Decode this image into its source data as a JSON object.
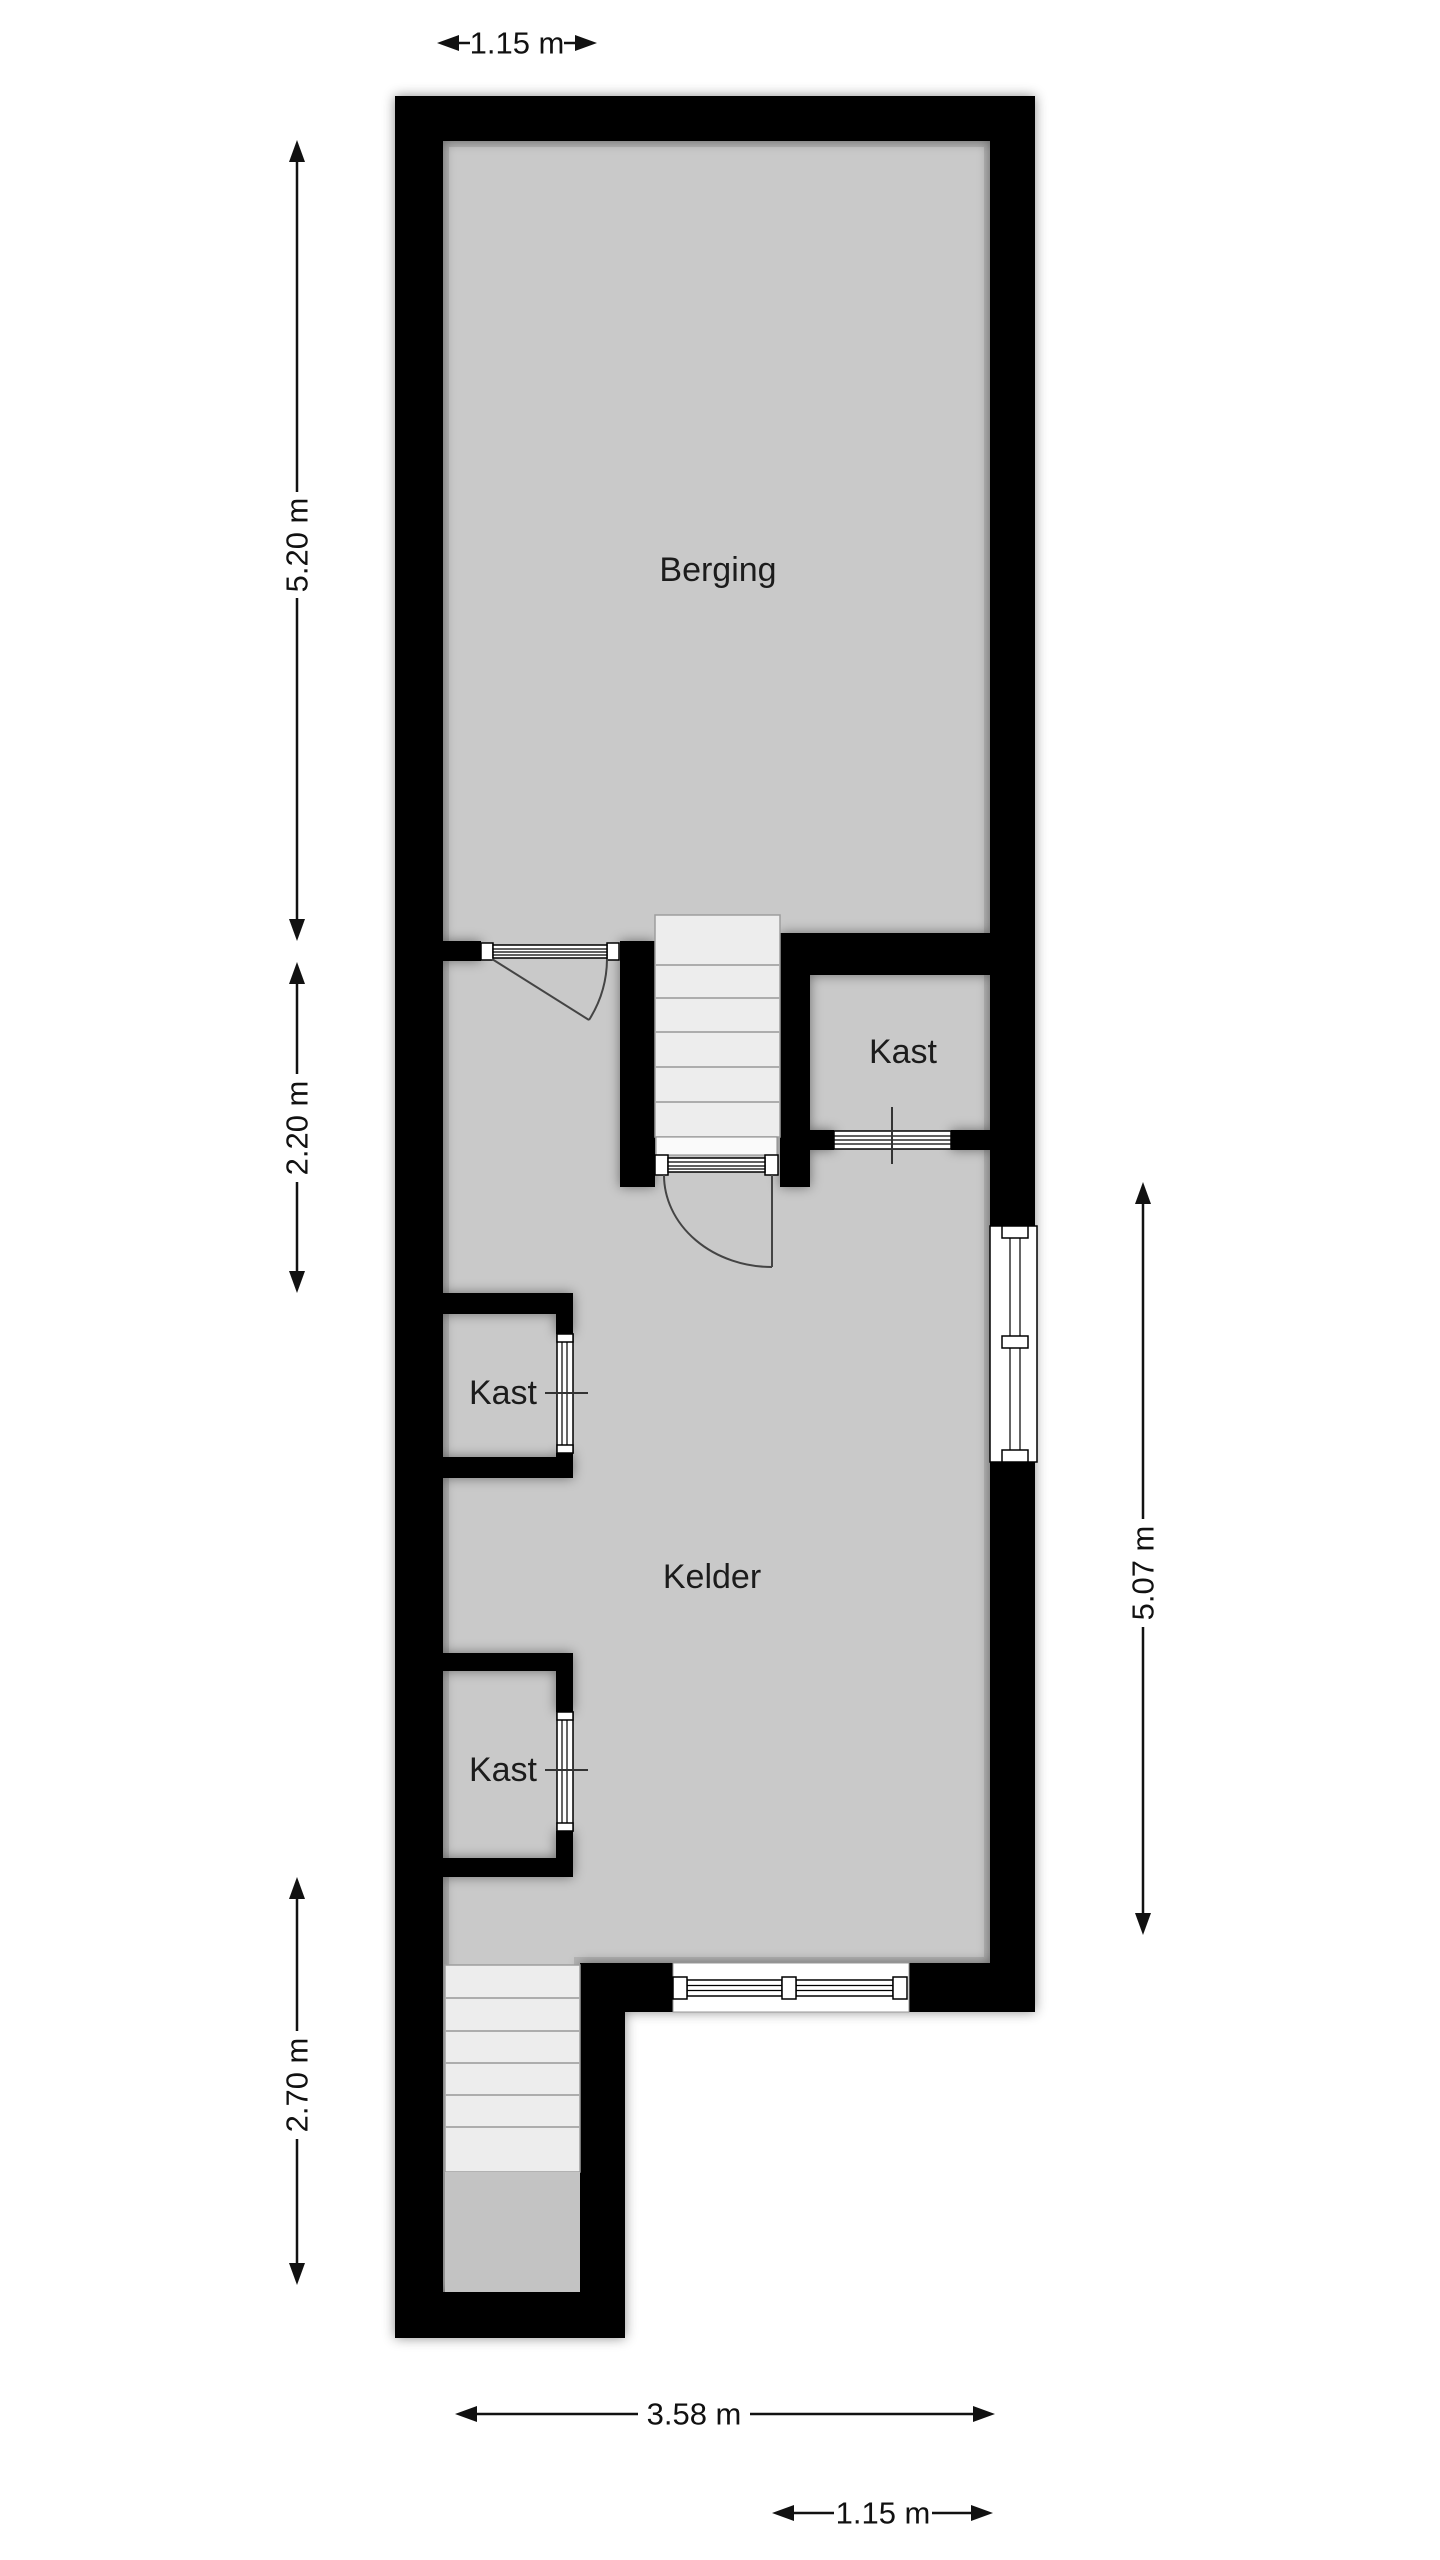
{
  "plan": {
    "title": "Basement floor plan",
    "rooms": [
      {
        "name": "berging",
        "label": "Berging"
      },
      {
        "name": "kelder",
        "label": "Kelder"
      },
      {
        "name": "kast-upper-right",
        "label": "Kast"
      },
      {
        "name": "kast-left-upper",
        "label": "Kast"
      },
      {
        "name": "kast-left-lower",
        "label": "Kast"
      }
    ],
    "dimensions": [
      {
        "name": "top-width",
        "label": "1.15 m"
      },
      {
        "name": "left-upper-height",
        "label": "5.20 m"
      },
      {
        "name": "left-middle-height",
        "label": "2.20 m"
      },
      {
        "name": "left-lower-height",
        "label": "2.70 m"
      },
      {
        "name": "right-height",
        "label": "5.07 m"
      },
      {
        "name": "bottom-width",
        "label": "3.58 m"
      },
      {
        "name": "bottom-right-width",
        "label": "1.15 m"
      }
    ],
    "colors": {
      "wall": "#000000",
      "floor": "#c9c9c9",
      "stair_tread": "#ededed",
      "stair_landing": "#c3c3c3",
      "background": "#ffffff",
      "annotation": "#111111"
    }
  }
}
